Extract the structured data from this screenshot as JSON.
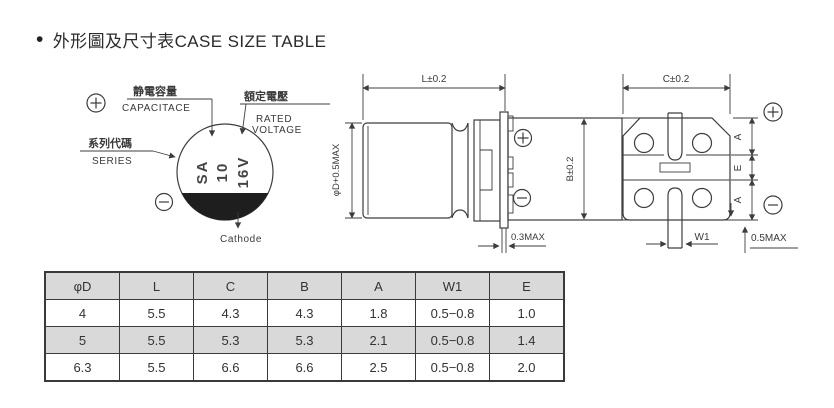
{
  "title": {
    "bullet": "•",
    "text": "外形圖及尺寸表CASE SIZE TABLE"
  },
  "marking_view": {
    "capacitance_zh": "静電容量",
    "capacitance_en": "CAPACITACE",
    "rated_voltage_zh": "額定電壓",
    "rated_voltage_en1": "RATED",
    "rated_voltage_en2": "VOLTAGE",
    "series_zh": "系列代碼",
    "series_en": "SERIES",
    "marking_line1": "SA",
    "marking_line2": "10",
    "marking_line3": "16V",
    "cathode_label": "Cathode",
    "plus_symbol": "⊕",
    "minus_symbol": "⊖"
  },
  "side_view": {
    "dim_length": "L±0.2",
    "dim_diameter": "φD+0.5MAX",
    "dim_height": "B±0.2",
    "dim_lead_thickness": "0.3MAX"
  },
  "bottom_view": {
    "dim_width": "C±0.2",
    "dim_a_top": "A",
    "dim_e": "E",
    "dim_a_bottom": "A",
    "dim_w1": "W1",
    "dim_standoff": "0.5MAX"
  },
  "case_table": {
    "headers": [
      "φD",
      "L",
      "C",
      "B",
      "A",
      "W1",
      "E"
    ],
    "rows": [
      [
        "4",
        "5.5",
        "4.3",
        "4.3",
        "1.8",
        "0.5−0.8",
        "1.0"
      ],
      [
        "5",
        "5.5",
        "5.3",
        "5.3",
        "2.1",
        "0.5−0.8",
        "1.4"
      ],
      [
        "6.3",
        "5.5",
        "6.6",
        "6.6",
        "2.5",
        "0.5−0.8",
        "2.0"
      ]
    ]
  }
}
